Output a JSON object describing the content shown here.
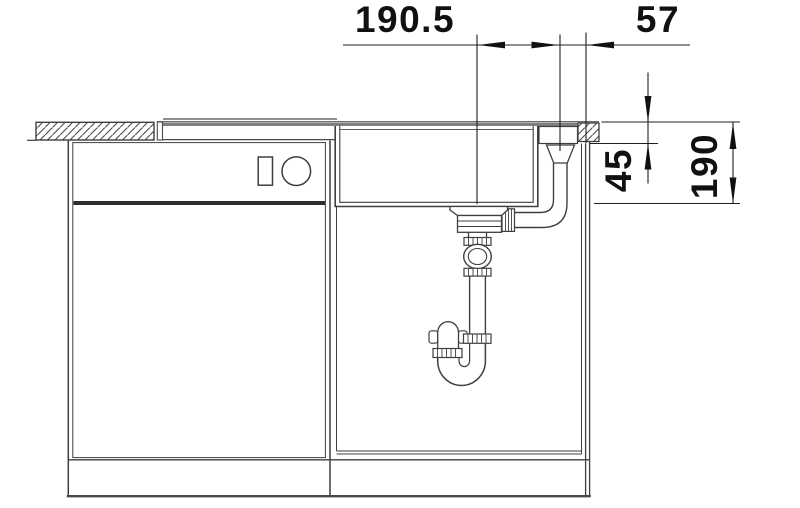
{
  "drawing": {
    "type": "technical-section-drawing",
    "subject": "kitchen-sink-installation-side-view",
    "dimensions": {
      "drain_offset": {
        "label": "190.5"
      },
      "edge_offset": {
        "label": "57"
      },
      "rim_depth": {
        "label": "45"
      },
      "bowl_depth": {
        "label": "190"
      }
    },
    "symbols": {
      "left_cabinet_controls": "rectangle-indicator-and-round-knob",
      "hatching": "countertop-cross-section"
    },
    "colors": {
      "background": "#ffffff",
      "line": "#3f3f3f",
      "dimension": "#1a1a1a",
      "rim_gray": "#7f7f7f",
      "divider_dark": "#2e2e2e"
    }
  }
}
